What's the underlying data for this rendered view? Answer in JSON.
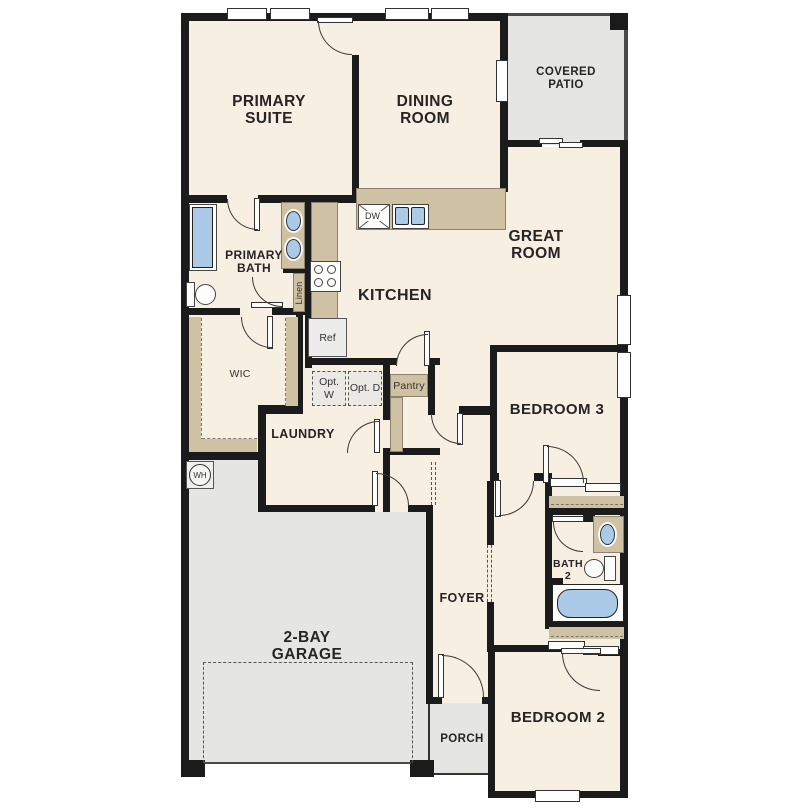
{
  "plan_title": "Single-story floor plan",
  "rooms": {
    "primary_suite": "PRIMARY SUITE",
    "dining_room": "DINING ROOM",
    "covered_patio": "COVERED PATIO",
    "great_room": "GREAT ROOM",
    "primary_bath": "PRIMARY BATH",
    "kitchen": "KITCHEN",
    "wic": "WIC",
    "laundry": "LAUNDRY",
    "bedroom3": "BEDROOM 3",
    "bath2": "BATH 2",
    "foyer": "FOYER",
    "garage": "2-BAY GARAGE",
    "porch": "PORCH",
    "bedroom2": "BEDROOM 2"
  },
  "fixtures": {
    "dishwasher": "DW",
    "refrigerator": "Ref",
    "pantry": "Pantry",
    "linen": "Linen",
    "optional_washer": "Opt. W",
    "optional_dryer": "Opt. D",
    "water_heater": "WH"
  },
  "colors": {
    "wall": "#1b1b1b",
    "floor": "#f7efe1",
    "hard_surface": "#e5e5e3",
    "counter_tan": "#cfc1a4",
    "water_blue": "#abcae8"
  }
}
